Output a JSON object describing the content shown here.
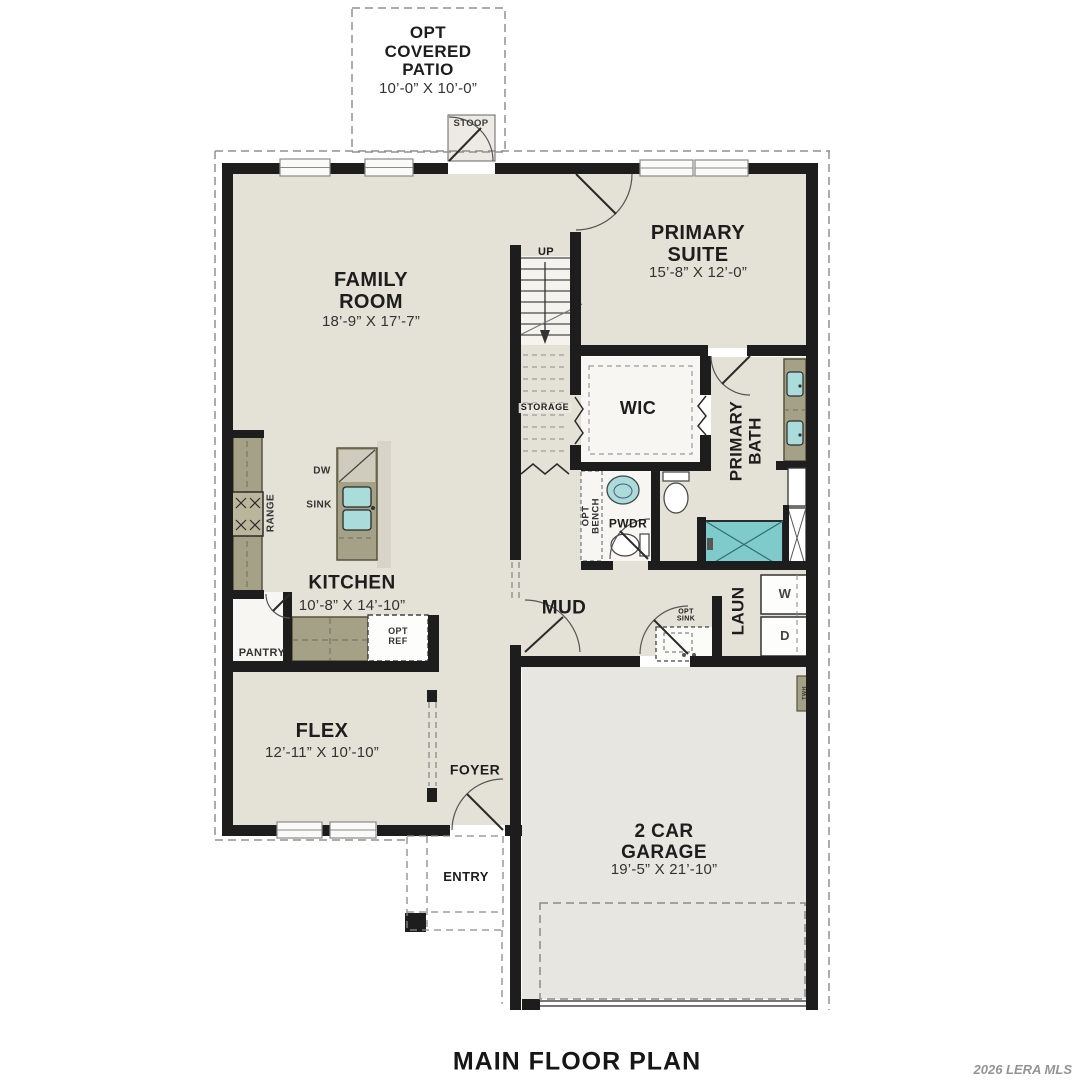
{
  "plan": {
    "title": "MAIN FLOOR PLAN",
    "watermark": "2026 LERA MLS",
    "rooms": {
      "patio": {
        "name": "OPT\nCOVERED\nPATIO",
        "dims": "10’-0” X 10’-0”"
      },
      "stoop": {
        "name": "STOOP"
      },
      "family_room": {
        "name": "FAMILY\nROOM",
        "dims": "18’-9” X 17’-7”"
      },
      "primary_suite": {
        "name": "PRIMARY\nSUITE",
        "dims": "15’-8” X 12’-0”"
      },
      "wic": {
        "name": "WIC"
      },
      "primary_bath": {
        "name": "PRIMARY\nBATH"
      },
      "storage": {
        "name": "STORAGE"
      },
      "powder": {
        "name": "PWDR"
      },
      "mud": {
        "name": "MUD"
      },
      "laundry": {
        "name": "LAUN"
      },
      "kitchen": {
        "name": "KITCHEN",
        "dims": "10’-8” X 14’-10”"
      },
      "pantry": {
        "name": "PANTRY"
      },
      "flex": {
        "name": "FLEX",
        "dims": "12’-11” X 10’-10”"
      },
      "foyer": {
        "name": "FOYER"
      },
      "entry": {
        "name": "ENTRY"
      },
      "garage": {
        "name": "2 CAR\nGARAGE",
        "dims": "19’-5” X 21’-10”"
      }
    },
    "annotations": {
      "up": "UP",
      "dw": "DW",
      "sink": "SINK",
      "range": "RANGE",
      "opt_ref": "OPT\nREF",
      "opt_sink": "OPT\nSINK",
      "opt_bench": "OPT\nBENCH",
      "washer": "W",
      "dryer": "D",
      "twh": "TWH"
    },
    "colors": {
      "floor_beige": "#e4e1d6",
      "garage_gray": "#e8e6e1",
      "counter_olive": "#a4a186",
      "fixture_teal": "#7fcaca",
      "sink_teal": "#aadcdc",
      "wall_black": "#1d1d1d",
      "dash_gray": "#909090"
    }
  }
}
